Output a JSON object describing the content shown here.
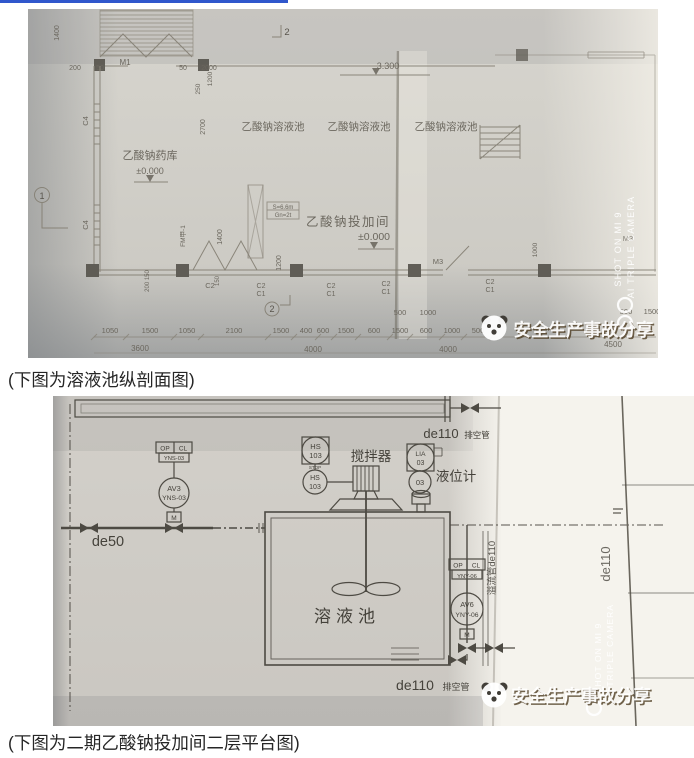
{
  "page": {
    "accent_blue": "#3057cc",
    "captions": {
      "section1": "(下图为溶液池纵剖面图)",
      "section2": "(下图为二期乙酸钠投加间二层平台图)"
    }
  },
  "watermark": {
    "brand": "安全生产事故分享",
    "camera_line1": "SHOT ON MI 9",
    "camera_line2": "AI TRIPLE CAMERA"
  },
  "plan": {
    "rooms": {
      "storage": "乙酸钠药库",
      "dosing": "乙酸钠投加间",
      "pool1": "乙酸钠溶液池",
      "pool2": "乙酸钠溶液池",
      "pool3": "乙酸钠溶液池"
    },
    "elevations": {
      "ground_left": "±0.000",
      "ground_center": "±0.000",
      "pool_top": "3.300"
    },
    "tags": {
      "door_m1": "M1",
      "door_m3": "M3",
      "door_m3b": "M3",
      "door_fm": "FM甲-1",
      "grid1": "1",
      "grid2_top": "2",
      "grid2_bottom": "2",
      "c4a": "C4",
      "c4b": "C4",
      "c2_left": "C2",
      "area_line1": "S=6.6m",
      "area_line2": "Gn=2t"
    },
    "window_pairs": [
      {
        "top": "C2",
        "bottom": "C1"
      },
      {
        "top": "C2",
        "bottom": "C1"
      },
      {
        "top": "C2",
        "bottom": "C1"
      },
      {
        "top": "C2",
        "bottom": "C1"
      }
    ],
    "dims": {
      "v1400": "1400",
      "d200": "200",
      "d50a": "50",
      "d50b": "50",
      "d2000": "2000",
      "v250": "250",
      "v1200": "1200",
      "v2700": "2700",
      "v200_150": "200 150",
      "v150": "150",
      "v1400b": "1400",
      "v1200b": "1200",
      "v1000r": "1000",
      "row1": [
        "1050",
        "1500",
        "1050",
        "2100",
        "1500",
        "400",
        "600",
        "1500",
        "600",
        "1500",
        "600",
        "1000",
        "500"
      ],
      "mid": [
        "500",
        "1000"
      ],
      "right": [
        "500",
        "1500"
      ],
      "row2": [
        "3600",
        "4000",
        "4000",
        "4500"
      ]
    }
  },
  "pid": {
    "equipment": {
      "agitator": "搅拌器",
      "level_gauge": "液位计",
      "tank": "溶液池"
    },
    "pipes": {
      "de50": "de50",
      "de110_top": "de110",
      "vent_top": "排空管",
      "de110_bottom": "de110",
      "vent_bottom": "排空管",
      "de110_right": "de110",
      "overflow": "溢流管de110"
    },
    "instruments": {
      "hs": "HS",
      "hs_num": "103",
      "hs2": "HS",
      "hs2_num": "103",
      "stop": "STOP",
      "lia": "LIA",
      "lia_num": "03",
      "lt_num": "03",
      "av3": "AV3",
      "av3_tag": "YNS-03",
      "av6": "AV6",
      "av6_tag": "YNY-06",
      "op1": "OP",
      "cl1": "CL",
      "box1_tag": "YNS-03",
      "op2": "OP",
      "cl2": "CL",
      "box2_tag": "YNY-06",
      "m1": "M",
      "m2": "M"
    }
  }
}
